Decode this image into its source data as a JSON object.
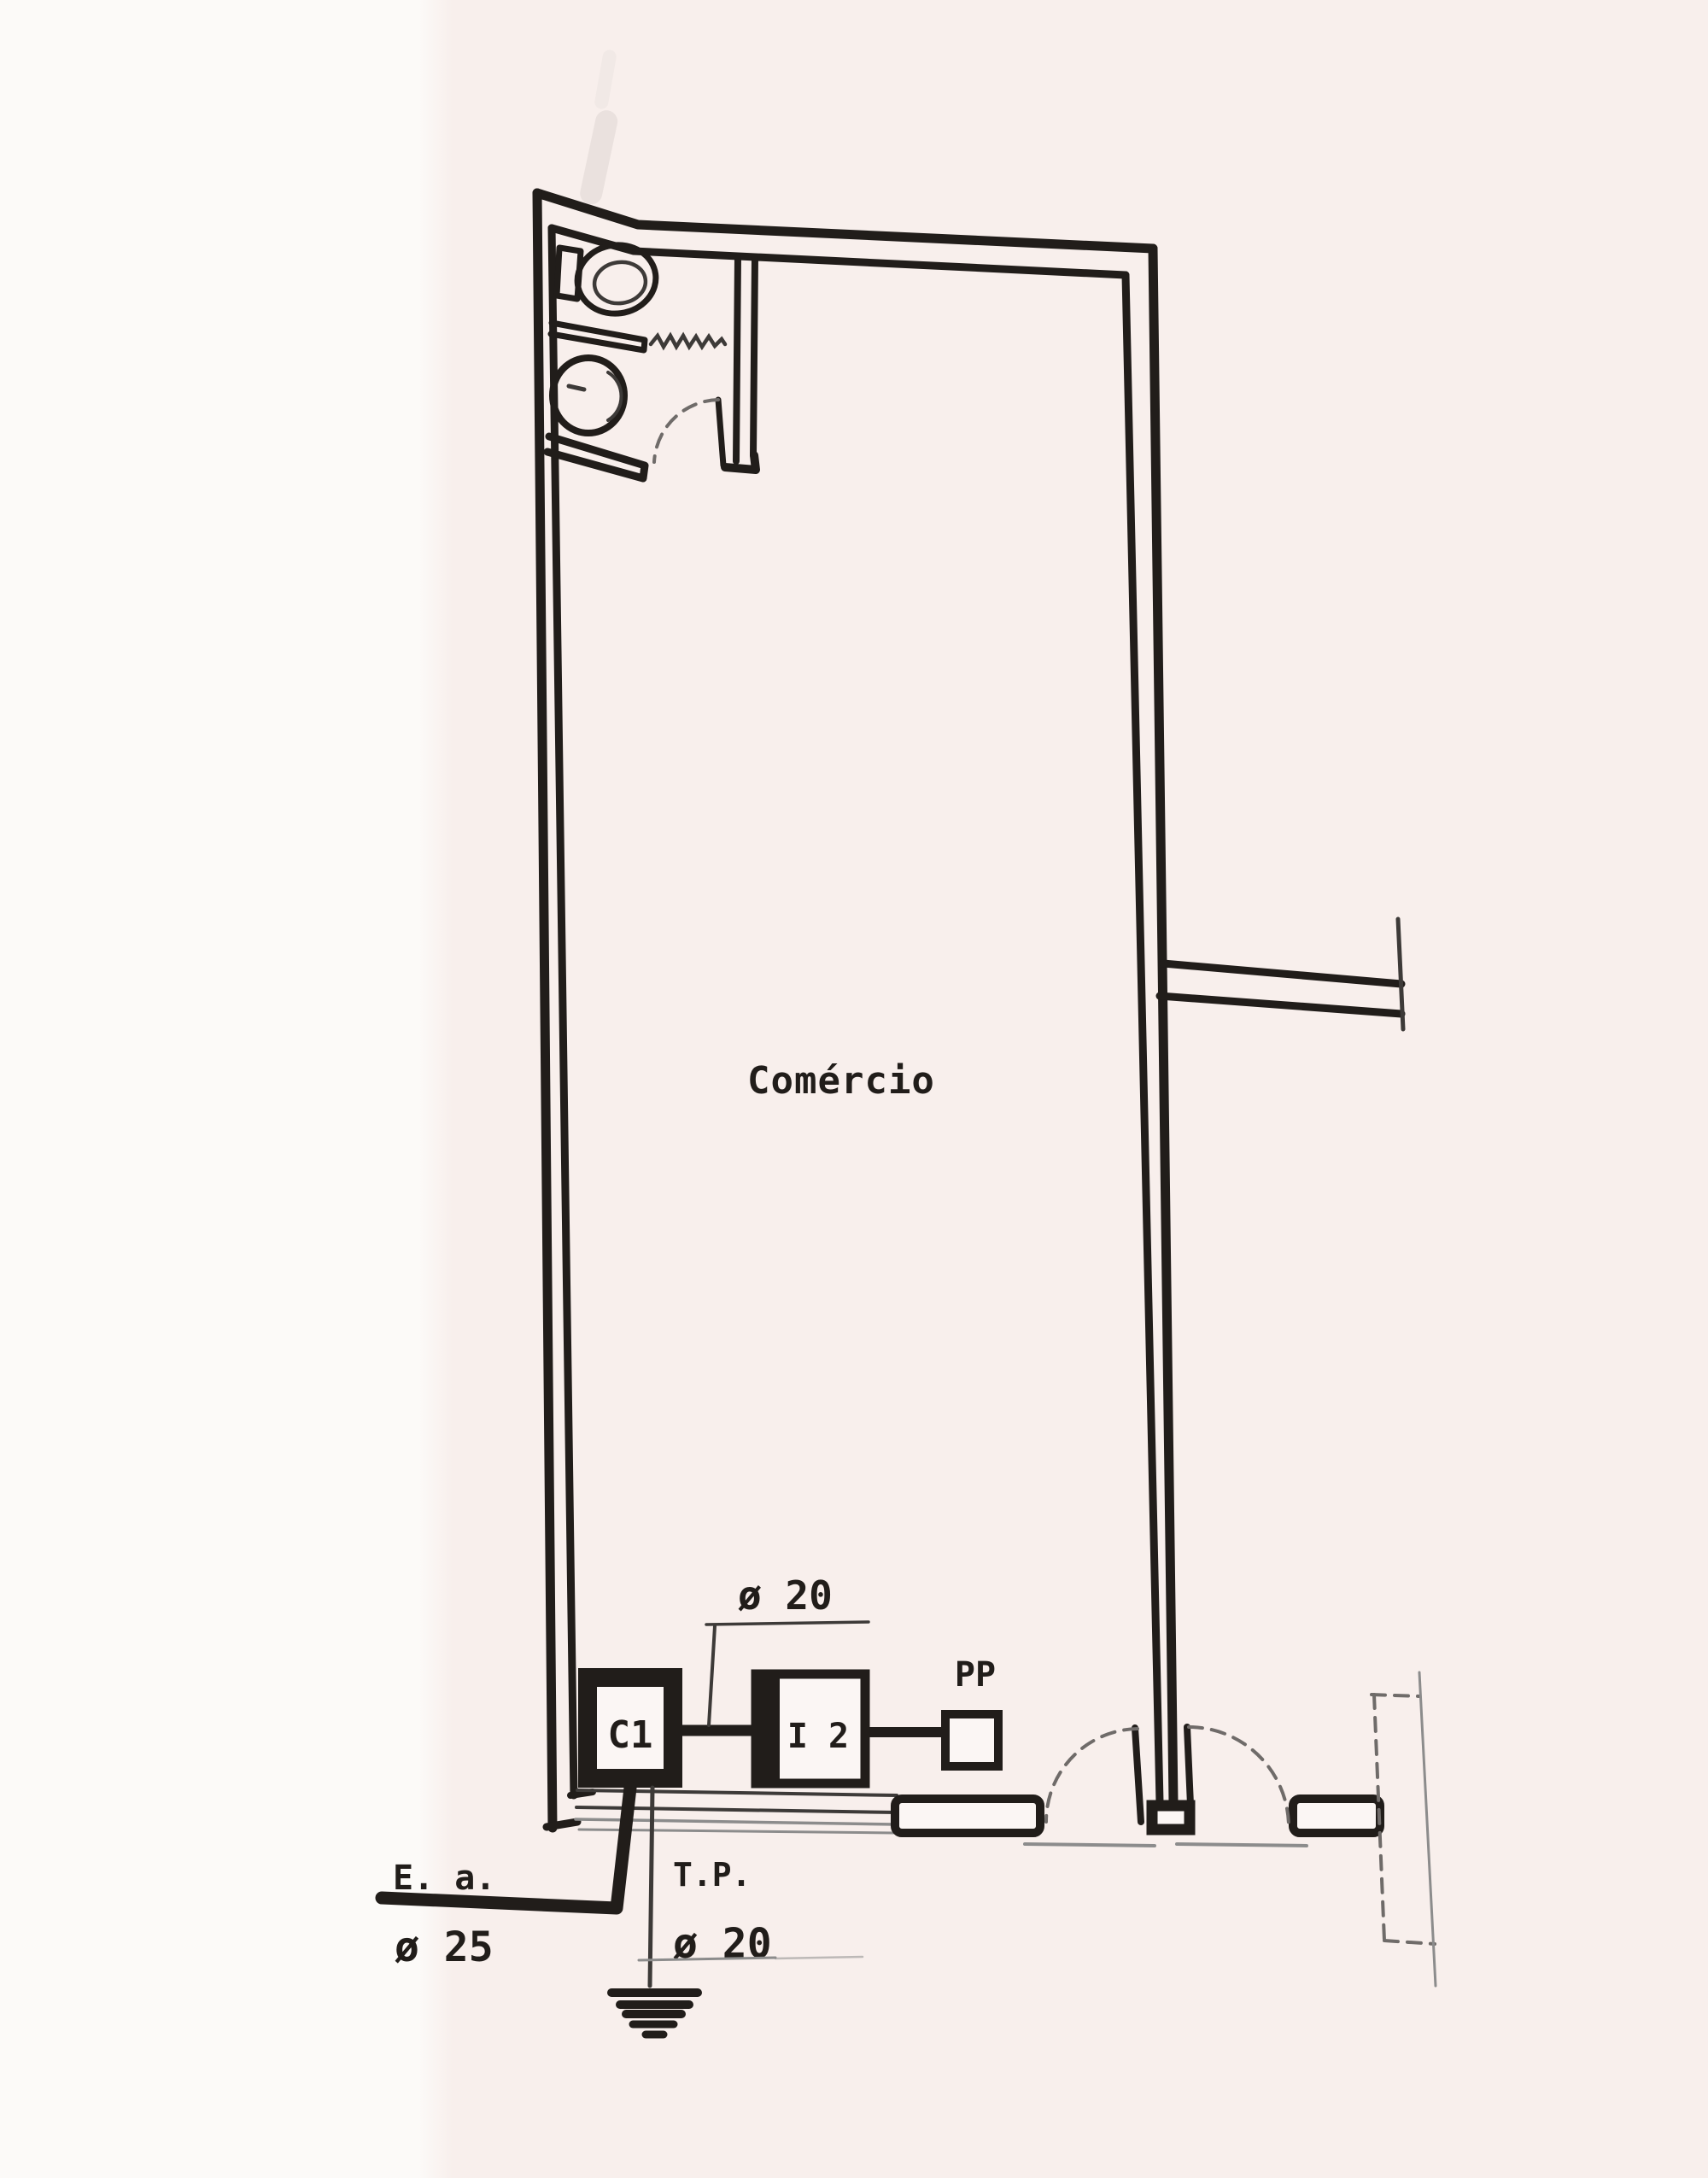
{
  "plan": {
    "room_label": "Comércio",
    "riser": {
      "box_c1": "C1",
      "box_i2": "I 2",
      "box_pp": "PP",
      "conduit_c1_i2_size": "ø 20",
      "entry_label": "E. a.",
      "entry_size": "ø 25",
      "ground_label": "T.P.",
      "ground_size": "ø 20"
    },
    "colors": {
      "ink": "#211d1a",
      "paper_left": "#fcfaf8",
      "paper_right": "#f8efec",
      "faint_line": "#8c8c8c"
    }
  }
}
